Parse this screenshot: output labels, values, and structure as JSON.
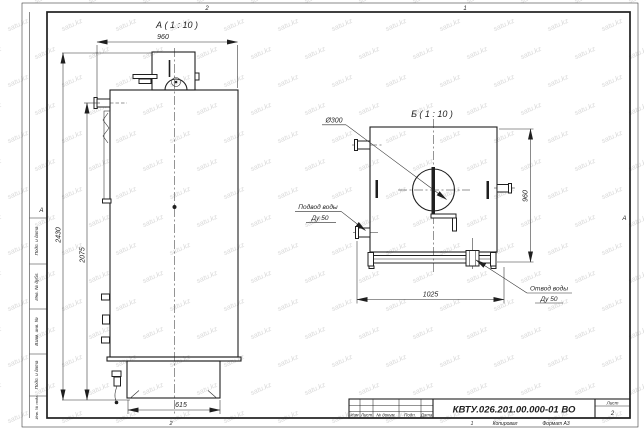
{
  "sheet": {
    "doc_number": "КВТУ.026.201.00.000-01 ВО",
    "sheet_label": "Лист",
    "sheet_number": "2",
    "copied_label": "Копировал",
    "format_label": "Формат А3",
    "title_block_headers": {
      "izm": "Изм",
      "list": "Лист",
      "doc": "№ докум.",
      "podp": "Подп.",
      "data": "Дата"
    },
    "side_fields": [
      "Подп. и дата",
      "Инв. № дубл.",
      "Взам. инв. №",
      "Подп. и дата",
      "Инв. № подл."
    ],
    "zone_markers": {
      "top_left": "2",
      "top_right": "1",
      "bottom_left": "2",
      "bottom_right": "1",
      "left": "А",
      "right": "А"
    }
  },
  "views": {
    "a": {
      "title": "А ( 1 : 10 )",
      "dim_width_top": "960",
      "dim_height_overall": "2430",
      "dim_height_body": "2075",
      "dim_width_base": "615"
    },
    "b": {
      "title": "Б ( 1 : 10 )",
      "diameter_label": "Ø300",
      "dim_height": "960",
      "dim_width": "1025",
      "inlet_label_line1": "Подвод воды",
      "inlet_label_line2": "Ду 50",
      "outlet_label_line1": "Отвод воды",
      "outlet_label_line2": "Ду 50"
    }
  },
  "watermark": {
    "text": "satu.kz"
  },
  "colors": {
    "line": "#1f1f1f",
    "watermark": "#d9d9d9"
  }
}
